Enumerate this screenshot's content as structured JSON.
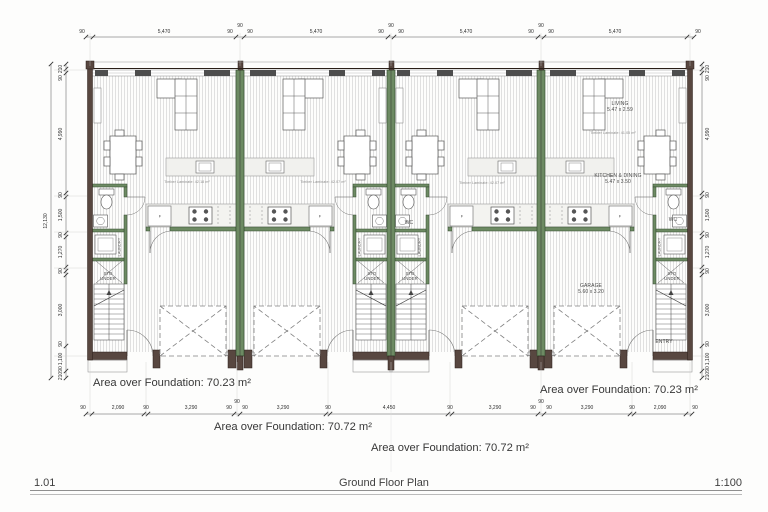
{
  "drawing": {
    "sheet_number": "1.01",
    "sheet_title": "Ground Floor Plan",
    "scale": "1:100"
  },
  "areas": [
    {
      "text": "Area over Foundation: 70.23 m²"
    },
    {
      "text": "Area over Foundation: 70.23 m²"
    },
    {
      "text": "Area over Foundation: 70.72 m²"
    },
    {
      "text": "Area over Foundation: 70.72 m²"
    }
  ],
  "rooms": [
    {
      "name": "living-label",
      "t": "LIVING\n5.47 x 2.59",
      "x": 620,
      "y": 107,
      "s": 5
    },
    {
      "name": "kitchen-dining-label",
      "t": "KITCHEN & DINING\n5.47 x 3.50",
      "x": 618,
      "y": 179,
      "s": 5
    },
    {
      "name": "garage-label",
      "t": "GARAGE\n5.60 x 3.20",
      "x": 591,
      "y": 289,
      "s": 5
    },
    {
      "name": "entry-label",
      "t": "ENTRY",
      "x": 664,
      "y": 342,
      "s": 5
    },
    {
      "name": "wc-label",
      "t": "WC",
      "x": 409,
      "y": 223,
      "s": 5
    },
    {
      "name": "wc-label",
      "t": "WC",
      "x": 673,
      "y": 220,
      "s": 5
    },
    {
      "name": "laundry-label",
      "t": "LAUNDRY",
      "x": 120,
      "y": 247,
      "s": 3.8,
      "rot": -90
    },
    {
      "name": "laundry-label",
      "t": "LAUNDRY",
      "x": 360,
      "y": 247,
      "s": 3.8,
      "rot": -90
    },
    {
      "name": "laundry-label",
      "t": "LAUNDRY",
      "x": 420,
      "y": 247,
      "s": 3.8,
      "rot": -90
    },
    {
      "name": "laundry-label",
      "t": "LAUNDRY",
      "x": 660,
      "y": 247,
      "s": 3.8,
      "rot": -90
    },
    {
      "name": "storage-under-stairs-label",
      "t": "STO\nUNDER",
      "x": 108,
      "y": 276,
      "s": 4.2
    },
    {
      "name": "storage-under-stairs-label",
      "t": "STO\nUNDER",
      "x": 372,
      "y": 276,
      "s": 4.2
    },
    {
      "name": "storage-under-stairs-label",
      "t": "STO\nUNDER",
      "x": 410,
      "y": 276,
      "s": 4.2
    },
    {
      "name": "storage-under-stairs-label",
      "t": "STO\nUNDER",
      "x": 672,
      "y": 276,
      "s": 4.2
    },
    {
      "name": "floor-finish-note",
      "t": "Timber Laminate: 42.18 m²",
      "x": 187,
      "y": 182,
      "s": 3.6,
      "color": "#8c8c8c"
    },
    {
      "name": "floor-finish-note",
      "t": "Timber Laminate: 42.07 m²",
      "x": 323,
      "y": 182,
      "s": 3.6,
      "color": "#8c8c8c"
    },
    {
      "name": "floor-finish-note",
      "t": "Timber Laminate: 42.07 m²",
      "x": 482,
      "y": 183,
      "s": 3.6,
      "color": "#8c8c8c"
    },
    {
      "name": "floor-finish-note",
      "t": "Timber Laminate: 41.05 m²",
      "x": 613,
      "y": 133,
      "s": 3.6,
      "color": "#8c8c8c"
    },
    {
      "name": "fridge-label",
      "t": "F",
      "x": 160,
      "y": 216,
      "s": 4
    },
    {
      "name": "fridge-label",
      "t": "F",
      "x": 320,
      "y": 216,
      "s": 4
    },
    {
      "name": "fridge-label",
      "t": "F",
      "x": 462,
      "y": 216,
      "s": 4
    },
    {
      "name": "fridge-label",
      "t": "F",
      "x": 620,
      "y": 216,
      "s": 4
    }
  ],
  "dimensions": {
    "top": [
      {
        "t": "90",
        "x": 82,
        "y": 32
      },
      {
        "t": "5,470",
        "x": 164,
        "y": 32
      },
      {
        "t": "90",
        "x": 230,
        "y": 32
      },
      {
        "t": "90",
        "x": 240,
        "y": 26
      },
      {
        "t": "90",
        "x": 250,
        "y": 32
      },
      {
        "t": "5,470",
        "x": 316,
        "y": 32
      },
      {
        "t": "90",
        "x": 381,
        "y": 32
      },
      {
        "t": "90",
        "x": 391,
        "y": 26
      },
      {
        "t": "90",
        "x": 401,
        "y": 32
      },
      {
        "t": "5,470",
        "x": 466,
        "y": 32
      },
      {
        "t": "90",
        "x": 531,
        "y": 32
      },
      {
        "t": "90",
        "x": 541,
        "y": 26
      },
      {
        "t": "90",
        "x": 551,
        "y": 32
      },
      {
        "t": "5,470",
        "x": 615,
        "y": 32
      },
      {
        "t": "90",
        "x": 698,
        "y": 32
      }
    ],
    "bottom": [
      {
        "t": "90",
        "x": 83,
        "y": 408
      },
      {
        "t": "2,090",
        "x": 118,
        "y": 408
      },
      {
        "t": "90",
        "x": 146,
        "y": 408
      },
      {
        "t": "3,290",
        "x": 191,
        "y": 408
      },
      {
        "t": "90",
        "x": 229,
        "y": 408
      },
      {
        "t": "90",
        "x": 237,
        "y": 402
      },
      {
        "t": "90",
        "x": 245,
        "y": 408
      },
      {
        "t": "3,290",
        "x": 283,
        "y": 408
      },
      {
        "t": "90",
        "x": 328,
        "y": 408
      },
      {
        "t": "4,450",
        "x": 389,
        "y": 408
      },
      {
        "t": "90",
        "x": 450,
        "y": 408
      },
      {
        "t": "3,290",
        "x": 495,
        "y": 408
      },
      {
        "t": "90",
        "x": 533,
        "y": 408
      },
      {
        "t": "90",
        "x": 541,
        "y": 402
      },
      {
        "t": "90",
        "x": 549,
        "y": 408
      },
      {
        "t": "3,290",
        "x": 587,
        "y": 408
      },
      {
        "t": "90",
        "x": 632,
        "y": 408
      },
      {
        "t": "2,090",
        "x": 660,
        "y": 408
      },
      {
        "t": "90",
        "x": 695,
        "y": 408
      }
    ],
    "left": [
      {
        "t": "210",
        "x": 61,
        "y": 69
      },
      {
        "t": "90",
        "x": 61,
        "y": 78
      },
      {
        "t": "4,990",
        "x": 61,
        "y": 134
      },
      {
        "t": "90",
        "x": 61,
        "y": 195
      },
      {
        "t": "1,500",
        "x": 61,
        "y": 215
      },
      {
        "t": "90",
        "x": 61,
        "y": 235
      },
      {
        "t": "1,270",
        "x": 61,
        "y": 252
      },
      {
        "t": "90",
        "x": 61,
        "y": 271
      },
      {
        "t": "3,000",
        "x": 61,
        "y": 310
      },
      {
        "t": "90",
        "x": 61,
        "y": 344
      },
      {
        "t": "1,100",
        "x": 61,
        "y": 359
      },
      {
        "t": "90",
        "x": 61,
        "y": 369
      },
      {
        "t": "210",
        "x": 61,
        "y": 376
      },
      {
        "t": "12,130",
        "x": 46,
        "y": 221
      }
    ],
    "right": [
      {
        "t": "210",
        "x": 708,
        "y": 69
      },
      {
        "t": "90",
        "x": 708,
        "y": 78
      },
      {
        "t": "4,990",
        "x": 708,
        "y": 134
      },
      {
        "t": "90",
        "x": 708,
        "y": 195
      },
      {
        "t": "1,500",
        "x": 708,
        "y": 215
      },
      {
        "t": "90",
        "x": 708,
        "y": 235
      },
      {
        "t": "1,270",
        "x": 708,
        "y": 252
      },
      {
        "t": "90",
        "x": 708,
        "y": 271
      },
      {
        "t": "3,000",
        "x": 708,
        "y": 310
      },
      {
        "t": "90",
        "x": 708,
        "y": 344
      },
      {
        "t": "1,100",
        "x": 708,
        "y": 359
      },
      {
        "t": "90",
        "x": 708,
        "y": 369
      },
      {
        "t": "210",
        "x": 708,
        "y": 376
      }
    ]
  }
}
